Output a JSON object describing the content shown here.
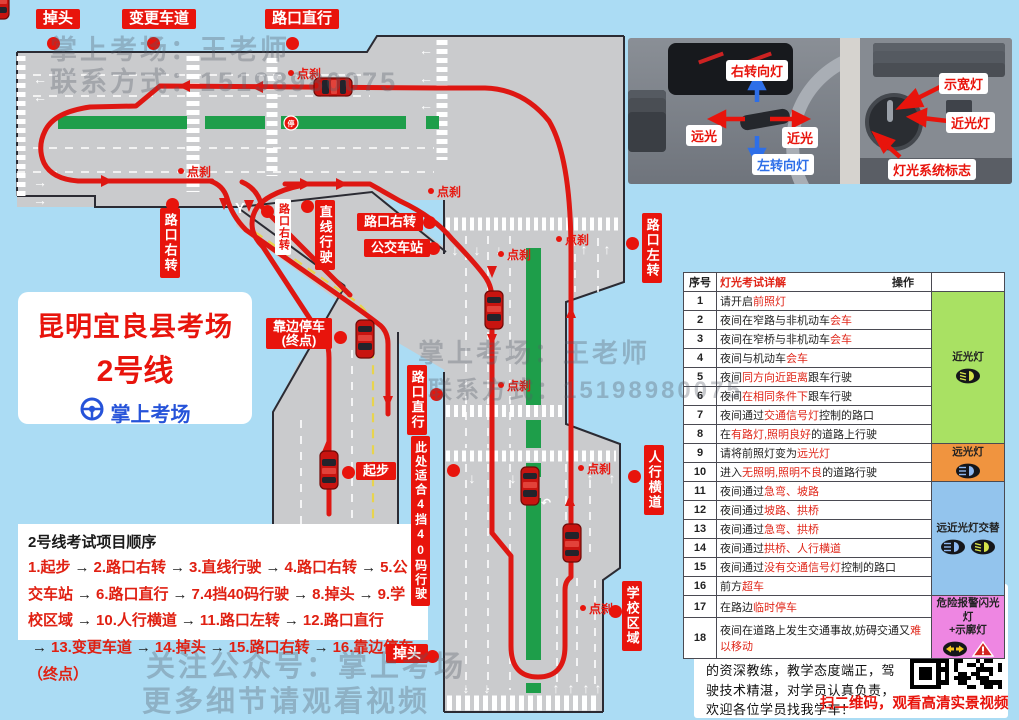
{
  "app": {
    "background": "#abdcf4"
  },
  "colors": {
    "accent_red": "#e8140c",
    "route_red": "#de1712",
    "brand_blue": "#2653d9",
    "contact_blue": "#4444d8",
    "road_gray": "#cacbcd",
    "median_green": "#1e9e4a",
    "table_green": "#a9e163",
    "table_orange": "#f0943f",
    "table_blue": "#93c4ed",
    "table_pink": "#ee86e2"
  },
  "title_card": {
    "line1": "昆明宜良县考场",
    "line2": "2号线",
    "brand": "掌上考场"
  },
  "map": {
    "labels": [
      {
        "text": "掉头",
        "x": 36,
        "y": 9,
        "style": "red-h",
        "fs": 15
      },
      {
        "text": "变更车道",
        "x": 122,
        "y": 9,
        "style": "red-h",
        "fs": 15
      },
      {
        "text": "路口直行",
        "x": 265,
        "y": 9,
        "style": "red-h",
        "fs": 15
      },
      {
        "text": "路口右转",
        "x": 160,
        "y": 208,
        "style": "red-v",
        "fs": 13
      },
      {
        "text": "路口右转",
        "x": 275,
        "y": 199,
        "style": "white-v",
        "fs": 11
      },
      {
        "text": "直线行驶",
        "x": 315,
        "y": 200,
        "style": "red-v",
        "fs": 13
      },
      {
        "text": "路口右转",
        "x": 357,
        "y": 213,
        "style": "red-h",
        "fs": 13
      },
      {
        "text": "公交车站",
        "x": 364,
        "y": 239,
        "style": "red-h",
        "fs": 13
      },
      {
        "text": "路口左转",
        "x": 642,
        "y": 213,
        "style": "red-v",
        "fs": 13
      },
      {
        "text": "靠边停车\n(终点)",
        "x": 266,
        "y": 318,
        "style": "red-h",
        "fs": 13
      },
      {
        "text": "路口直行",
        "x": 407,
        "y": 365,
        "style": "red-v",
        "fs": 13
      },
      {
        "text": "此处适合4挡40码行驶",
        "x": 411,
        "y": 436,
        "style": "red-v",
        "fs": 12
      },
      {
        "text": "起步",
        "x": 356,
        "y": 462,
        "style": "red-h",
        "fs": 13
      },
      {
        "text": "人行横道",
        "x": 644,
        "y": 445,
        "style": "red-v",
        "fs": 13
      },
      {
        "text": "学校区域",
        "x": 622,
        "y": 581,
        "style": "red-v",
        "fs": 13
      },
      {
        "text": "掉头",
        "x": 386,
        "y": 644,
        "style": "red-h",
        "fs": 14
      }
    ],
    "dots": [
      [
        53,
        43
      ],
      [
        153,
        43
      ],
      [
        292,
        43
      ],
      [
        172,
        204
      ],
      [
        267,
        211
      ],
      [
        307,
        206
      ],
      [
        429,
        222
      ],
      [
        433,
        248
      ],
      [
        632,
        243
      ],
      [
        436,
        394
      ],
      [
        453,
        470
      ],
      [
        634,
        476
      ],
      [
        615,
        611
      ],
      [
        432,
        656
      ],
      [
        340,
        337
      ],
      [
        348,
        472
      ]
    ],
    "brake_marks": [
      {
        "x": 288,
        "y": 65
      },
      {
        "x": 178,
        "y": 163
      },
      {
        "x": 428,
        "y": 183
      },
      {
        "x": 498,
        "y": 246
      },
      {
        "x": 498,
        "y": 377
      },
      {
        "x": 578,
        "y": 460
      },
      {
        "x": 580,
        "y": 600
      },
      {
        "x": 556,
        "y": 231
      }
    ],
    "road_markings": {
      "y_fork": "Y",
      "stop_sign": "停"
    },
    "watermarks": [
      {
        "text": "掌上考场：王老师",
        "x": 50,
        "y": 28,
        "fs": 27
      },
      {
        "text": "联系方式：15198980075",
        "x": 50,
        "y": 60,
        "fs": 27
      },
      {
        "text": "掌上考场：王老师",
        "x": 418,
        "y": 333,
        "fs": 26
      },
      {
        "text": "联系方式：15198980075",
        "x": 428,
        "y": 370,
        "fs": 24
      },
      {
        "text": "关注公众号：掌上考场",
        "x": 146,
        "y": 643,
        "fs": 29
      },
      {
        "text": "更多细节请观看视频",
        "x": 142,
        "y": 678,
        "fs": 29
      }
    ]
  },
  "sequence": {
    "title": "2号线考试项目顺序",
    "arrow": "→",
    "items": [
      "1.起步",
      "2.路口右转",
      "3.直线行驶",
      "4.路口右转",
      "5.公交车站",
      "6.路口直行",
      "7.4挡40码行驶",
      "8.掉头",
      "9.学校区域",
      "10.人行横道",
      "11.路口左转",
      "12.路口直行",
      "13.变更车道",
      "14.掉头",
      "15.路口右转",
      "16.靠边停车（终点）"
    ]
  },
  "photo": {
    "labels": [
      {
        "text": "右转向灯",
        "x": 726,
        "y": 60,
        "c": "#e8140c"
      },
      {
        "text": "远光",
        "x": 686,
        "y": 125,
        "c": "#e8140c"
      },
      {
        "text": "近光",
        "x": 782,
        "y": 127,
        "c": "#e8140c"
      },
      {
        "text": "左转向灯",
        "x": 752,
        "y": 154,
        "c": "#2e6fe8"
      },
      {
        "text": "示宽灯",
        "x": 939,
        "y": 73,
        "c": "#e8140c"
      },
      {
        "text": "近光灯",
        "x": 946,
        "y": 112,
        "c": "#e8140c"
      },
      {
        "text": "灯光系统标志",
        "x": 888,
        "y": 159,
        "c": "#e8140c"
      }
    ]
  },
  "table": {
    "header": {
      "col_no": "序号",
      "col_detail": "灯光考试详解",
      "col_op": "操作"
    },
    "rows": [
      {
        "no": "1",
        "segs": [
          [
            "请开启",
            "k"
          ],
          [
            "前照灯",
            "r"
          ]
        ]
      },
      {
        "no": "2",
        "segs": [
          [
            "夜间在窄路与非机动车",
            "k"
          ],
          [
            "会车",
            "r"
          ]
        ]
      },
      {
        "no": "3",
        "segs": [
          [
            "夜间在窄桥与非机动车",
            "k"
          ],
          [
            "会车",
            "r"
          ]
        ]
      },
      {
        "no": "4",
        "segs": [
          [
            "夜间与机动车",
            "k"
          ],
          [
            "会车",
            "r"
          ]
        ]
      },
      {
        "no": "5",
        "segs": [
          [
            "夜间",
            "k"
          ],
          [
            "同方向近距离",
            "r"
          ],
          [
            "跟车行驶",
            "k"
          ]
        ]
      },
      {
        "no": "6",
        "segs": [
          [
            "夜间",
            "k"
          ],
          [
            "在相同条件下",
            "r"
          ],
          [
            "跟车行驶",
            "k"
          ]
        ]
      },
      {
        "no": "7",
        "segs": [
          [
            "夜间通过",
            "k"
          ],
          [
            "交通信号灯",
            "r"
          ],
          [
            "控制的路口",
            "k"
          ]
        ]
      },
      {
        "no": "8",
        "segs": [
          [
            "在",
            "k"
          ],
          [
            "有路灯,照明良好",
            "r"
          ],
          [
            "的道路上行驶",
            "k"
          ]
        ]
      },
      {
        "no": "9",
        "segs": [
          [
            "请将前照灯变为",
            "k"
          ],
          [
            "远光灯",
            "r"
          ]
        ]
      },
      {
        "no": "10",
        "segs": [
          [
            "进入",
            "k"
          ],
          [
            "无照明,照明不良",
            "r"
          ],
          [
            "的道路行驶",
            "k"
          ]
        ]
      },
      {
        "no": "11",
        "segs": [
          [
            "夜间通过",
            "k"
          ],
          [
            "急弯、坡路",
            "r"
          ]
        ]
      },
      {
        "no": "12",
        "segs": [
          [
            "夜间通过",
            "k"
          ],
          [
            "坡路、拱桥",
            "r"
          ]
        ]
      },
      {
        "no": "13",
        "segs": [
          [
            "夜间通过",
            "k"
          ],
          [
            "急弯、拱桥",
            "r"
          ]
        ]
      },
      {
        "no": "14",
        "segs": [
          [
            "夜间通过",
            "k"
          ],
          [
            "拱桥、人行横道",
            "r"
          ]
        ]
      },
      {
        "no": "15",
        "segs": [
          [
            "夜间通过",
            "k"
          ],
          [
            "没有交通信号灯",
            "r"
          ],
          [
            "控制的路口",
            "k"
          ]
        ]
      },
      {
        "no": "16",
        "segs": [
          [
            "前方",
            "k"
          ],
          [
            "超车",
            "r"
          ]
        ]
      },
      {
        "no": "17",
        "segs": [
          [
            "在路边",
            "k"
          ],
          [
            "临时停车",
            "r"
          ]
        ]
      },
      {
        "no": "18",
        "segs": [
          [
            "夜间在道路上发生交通事故,妨碍交通又",
            "k"
          ],
          [
            "难以移动",
            "r"
          ]
        ]
      }
    ],
    "groups": [
      {
        "span": 8,
        "label": "近光灯",
        "color": "#a9e163",
        "icons": [
          "low"
        ]
      },
      {
        "span": 2,
        "label": "远光灯",
        "color": "#f0943f",
        "icons": [
          "high"
        ]
      },
      {
        "span": 6,
        "label": "远近光灯交替",
        "color": "#93c4ed",
        "icons": [
          "high",
          "low"
        ]
      },
      {
        "span": 2,
        "label": "危险报警闪光灯\n+示廓灯",
        "color": "#ee86e2",
        "icons": [
          "hazard",
          "warn"
        ]
      }
    ]
  },
  "contact": {
    "name": "王老师",
    "phone_label": "联系电话：",
    "phone": "15198980075",
    "body": "本人有多年的驾驶经验，是业界的资深教练，教学态度端正，驾驶技术精湛，对学员认真负责，欢迎各位学员找我学车！",
    "qr_caption": "扫二维码，观看高清实景视频"
  }
}
